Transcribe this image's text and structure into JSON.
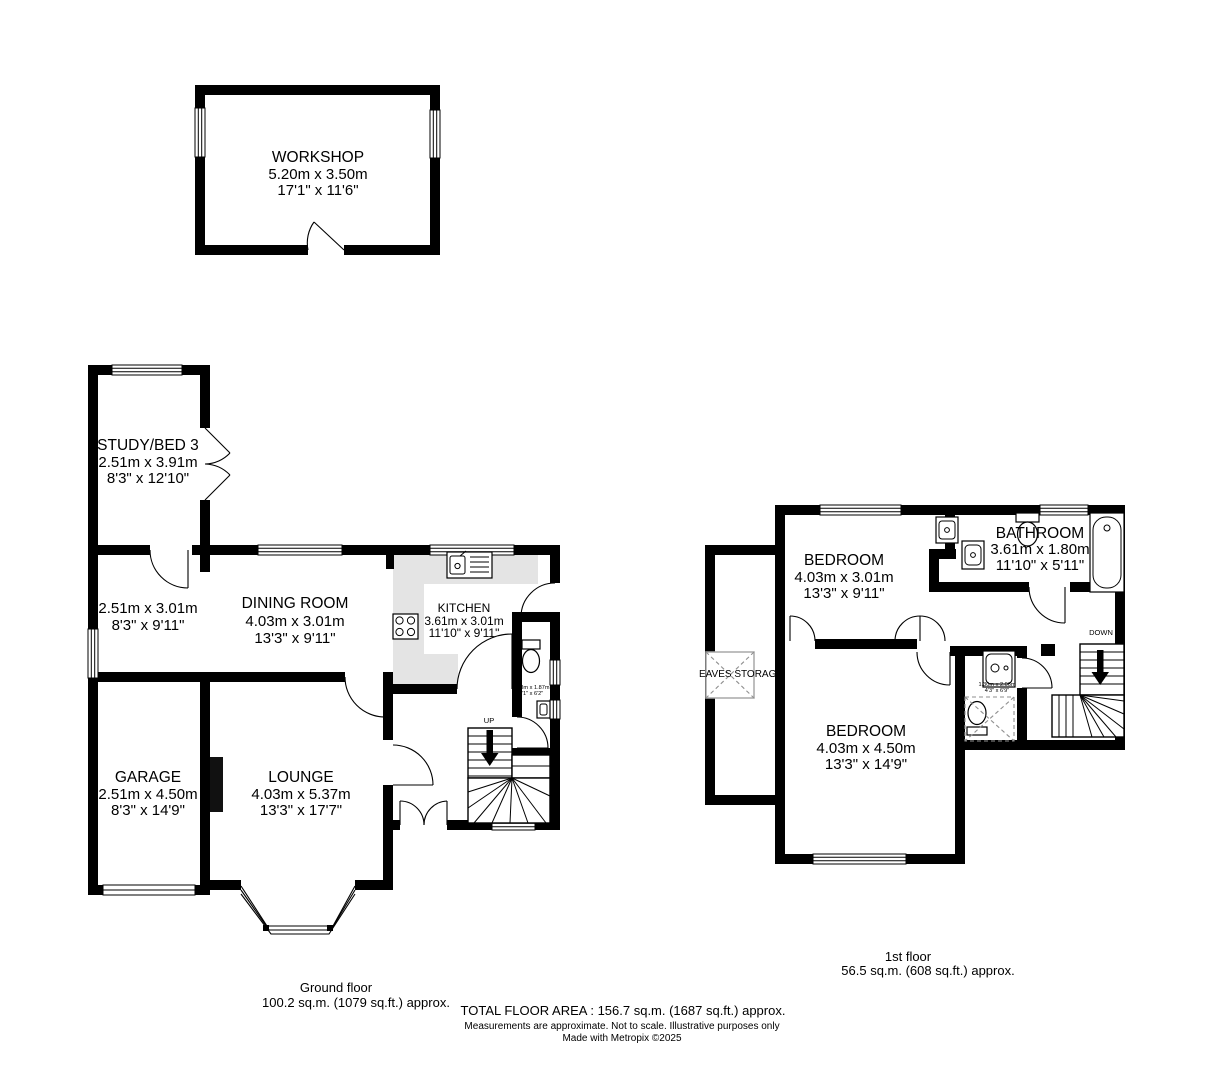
{
  "workshop": {
    "name": "WORKSHOP",
    "metric": "5.20m x 3.50m",
    "imperial": "17'1\" x 11'6\""
  },
  "ground": {
    "title": "Ground floor",
    "area": "100.2 sq.m. (1079 sq.ft.) approx.",
    "up_label": "UP",
    "rooms": {
      "study": {
        "name": "STUDY/BED 3",
        "metric": "2.51m x 3.91m",
        "imperial": "8'3\" x 12'10\""
      },
      "side_room": {
        "metric": "2.51m x 3.01m",
        "imperial": "8'3\" x 9'11\""
      },
      "dining": {
        "name": "DINING ROOM",
        "metric": "4.03m x 3.01m",
        "imperial": "13'3\" x 9'11\""
      },
      "kitchen": {
        "name": "KITCHEN",
        "metric": "3.61m x 3.01m",
        "imperial": "11'10\" x 9'11\""
      },
      "wc": {
        "metric": "0.93m x 1.87m",
        "imperial": "3'1\" x 6'2\""
      },
      "garage": {
        "name": "GARAGE",
        "metric": "2.51m x 4.50m",
        "imperial": "8'3\" x 14'9\""
      },
      "lounge": {
        "name": "LOUNGE",
        "metric": "4.03m x 5.37m",
        "imperial": "13'3\" x 17'7\""
      }
    }
  },
  "first": {
    "title": "1st floor",
    "area": "56.5 sq.m. (608 sq.ft.) approx.",
    "down_label": "DOWN",
    "rooms": {
      "bedroom1": {
        "name": "BEDROOM",
        "metric": "4.03m x 3.01m",
        "imperial": "13'3\" x 9'11\""
      },
      "bathroom": {
        "name": "BATHROOM",
        "metric": "3.61m x 1.80m",
        "imperial": "11'10\" x 5'11\""
      },
      "bedroom2": {
        "name": "BEDROOM",
        "metric": "4.03m x 4.50m",
        "imperial": "13'3\" x 14'9\""
      },
      "ensuite": {
        "name": "EN-SUITE",
        "metric": "1.30m x 2.06m",
        "imperial": "4'3\" x 6'9\""
      },
      "eaves": {
        "name": "EAVES STORAGE"
      }
    }
  },
  "footer": {
    "total": "TOTAL FLOOR AREA : 156.7 sq.m. (1687 sq.ft.) approx.",
    "disclaimer": "Measurements are approximate.  Not to scale.  Illustrative purposes only",
    "credit": "Made with Metropix ©2025"
  },
  "colors": {
    "wall": "#000000",
    "kitchen_floor": "#e4e4e4"
  }
}
